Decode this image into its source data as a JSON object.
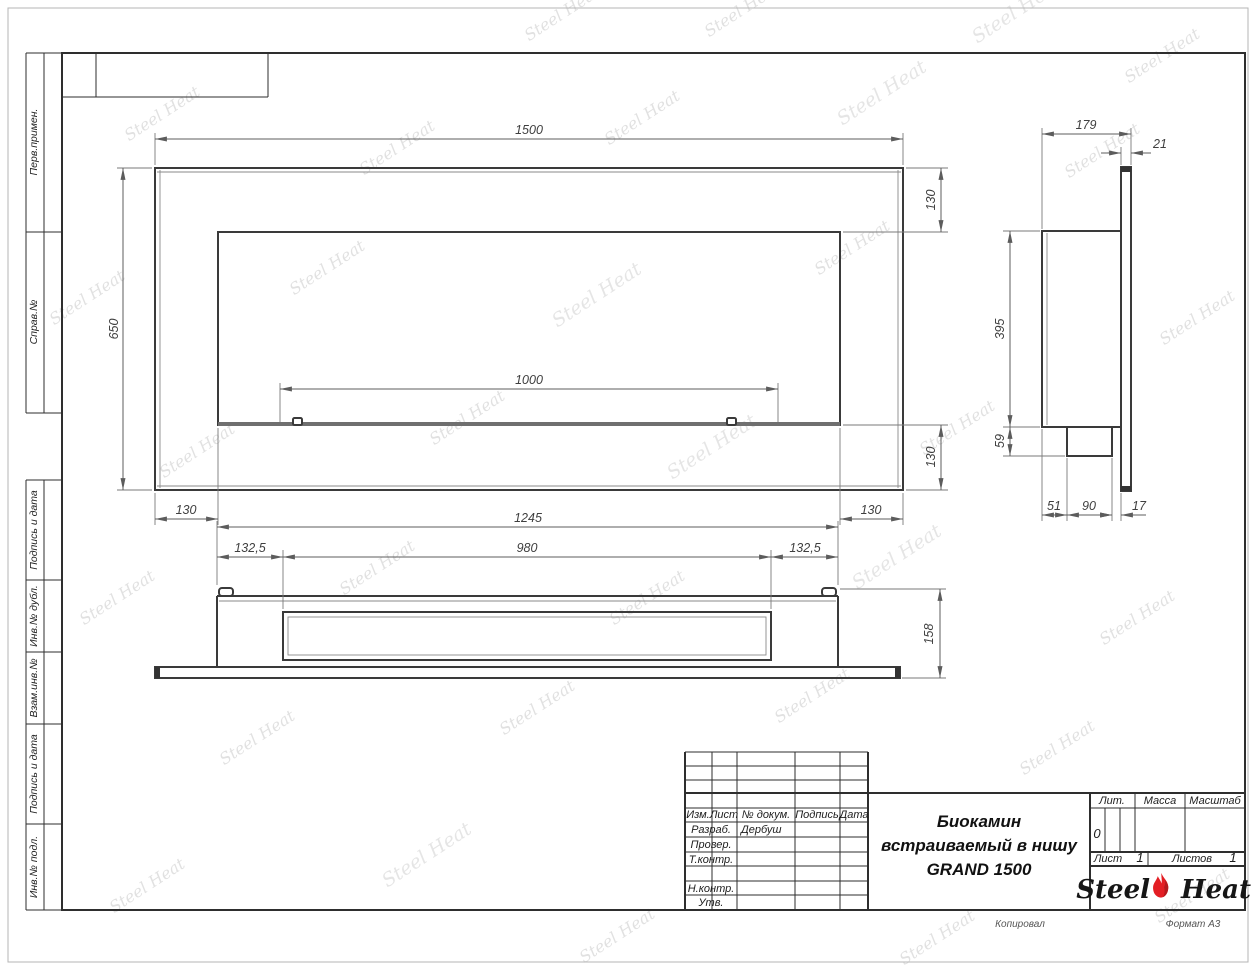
{
  "colors": {
    "flame_red": "#e31e24",
    "line": "#3a3a3a"
  },
  "watermark": {
    "text": "Steel Heat"
  },
  "left_margin": {
    "labels": [
      "Перв.примен.",
      "Справ.№",
      "Подпись и дата",
      "Инв.№ дубл.",
      "Взам.инв.№",
      "Подпись и дата",
      "Инв.№ подл."
    ]
  },
  "front_view": {
    "width": "1500",
    "height": "650",
    "burner_width": "1000",
    "offset_top": "130",
    "offset_bottom": "130",
    "offset_left": "130",
    "offset_right": "130"
  },
  "side_view": {
    "depth": "179",
    "panel_thickness": "21",
    "body_height": "395",
    "tray_height": "59",
    "front_gap": "51",
    "tray_depth": "90",
    "back_gap": "17"
  },
  "bottom_view": {
    "body_width": "1245",
    "side_margin_left": "132,5",
    "slot_width": "980",
    "side_margin_right": "132,5",
    "depth": "158"
  },
  "title_block": {
    "revision_cols": [
      "Изм.",
      "Лист",
      "№ докум.",
      "Подпись",
      "Дата"
    ],
    "rows": [
      {
        "label": "Разраб.",
        "value": "Дербуш"
      },
      {
        "label": "Провер.",
        "value": ""
      },
      {
        "label": "Т.контр.",
        "value": ""
      },
      {
        "label": "Н.контр.",
        "value": ""
      },
      {
        "label": "Утв.",
        "value": ""
      }
    ],
    "product_title": [
      "Биокамин",
      "встраиваемый в нишу",
      "GRAND 1500"
    ],
    "lit_label": "Лит.",
    "lit_value": "0",
    "mass_label": "Масса",
    "scale_label": "Масштаб",
    "sheet_label": "Лист",
    "sheet_value": "1",
    "sheets_label": "Листов",
    "sheets_value": "1",
    "logo": {
      "part1": "Steel",
      "part2": "Heat"
    },
    "copied_label": "Копировал",
    "format_label": "Формат А3"
  }
}
